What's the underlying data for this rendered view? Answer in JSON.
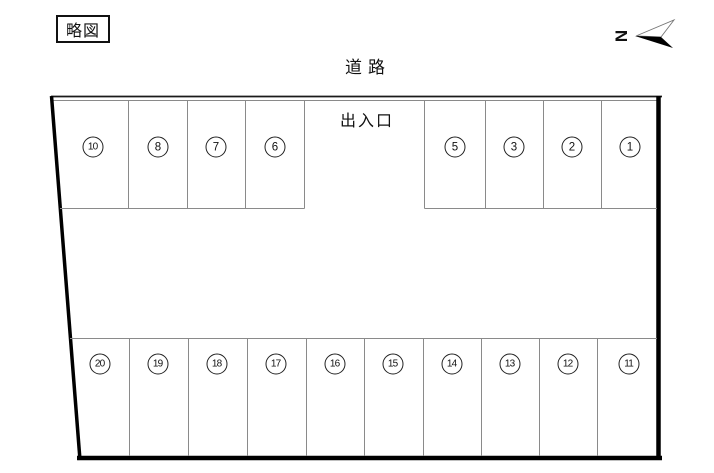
{
  "legend": {
    "title": "略図"
  },
  "compass": {
    "letter": "N"
  },
  "labels": {
    "road": "道路",
    "entrance": "出入口"
  },
  "stalls": {
    "top_left": [
      "10",
      "8",
      "7",
      "6"
    ],
    "top_right": [
      "5",
      "3",
      "2",
      "1"
    ],
    "bottom": [
      "20",
      "19",
      "18",
      "17",
      "16",
      "15",
      "14",
      "13",
      "12",
      "11"
    ]
  },
  "colors": {
    "boundary_thick": "#000000",
    "boundary_thin": "#1a1a1a",
    "stall_line": "#8a8a8a",
    "text": "#111111"
  }
}
